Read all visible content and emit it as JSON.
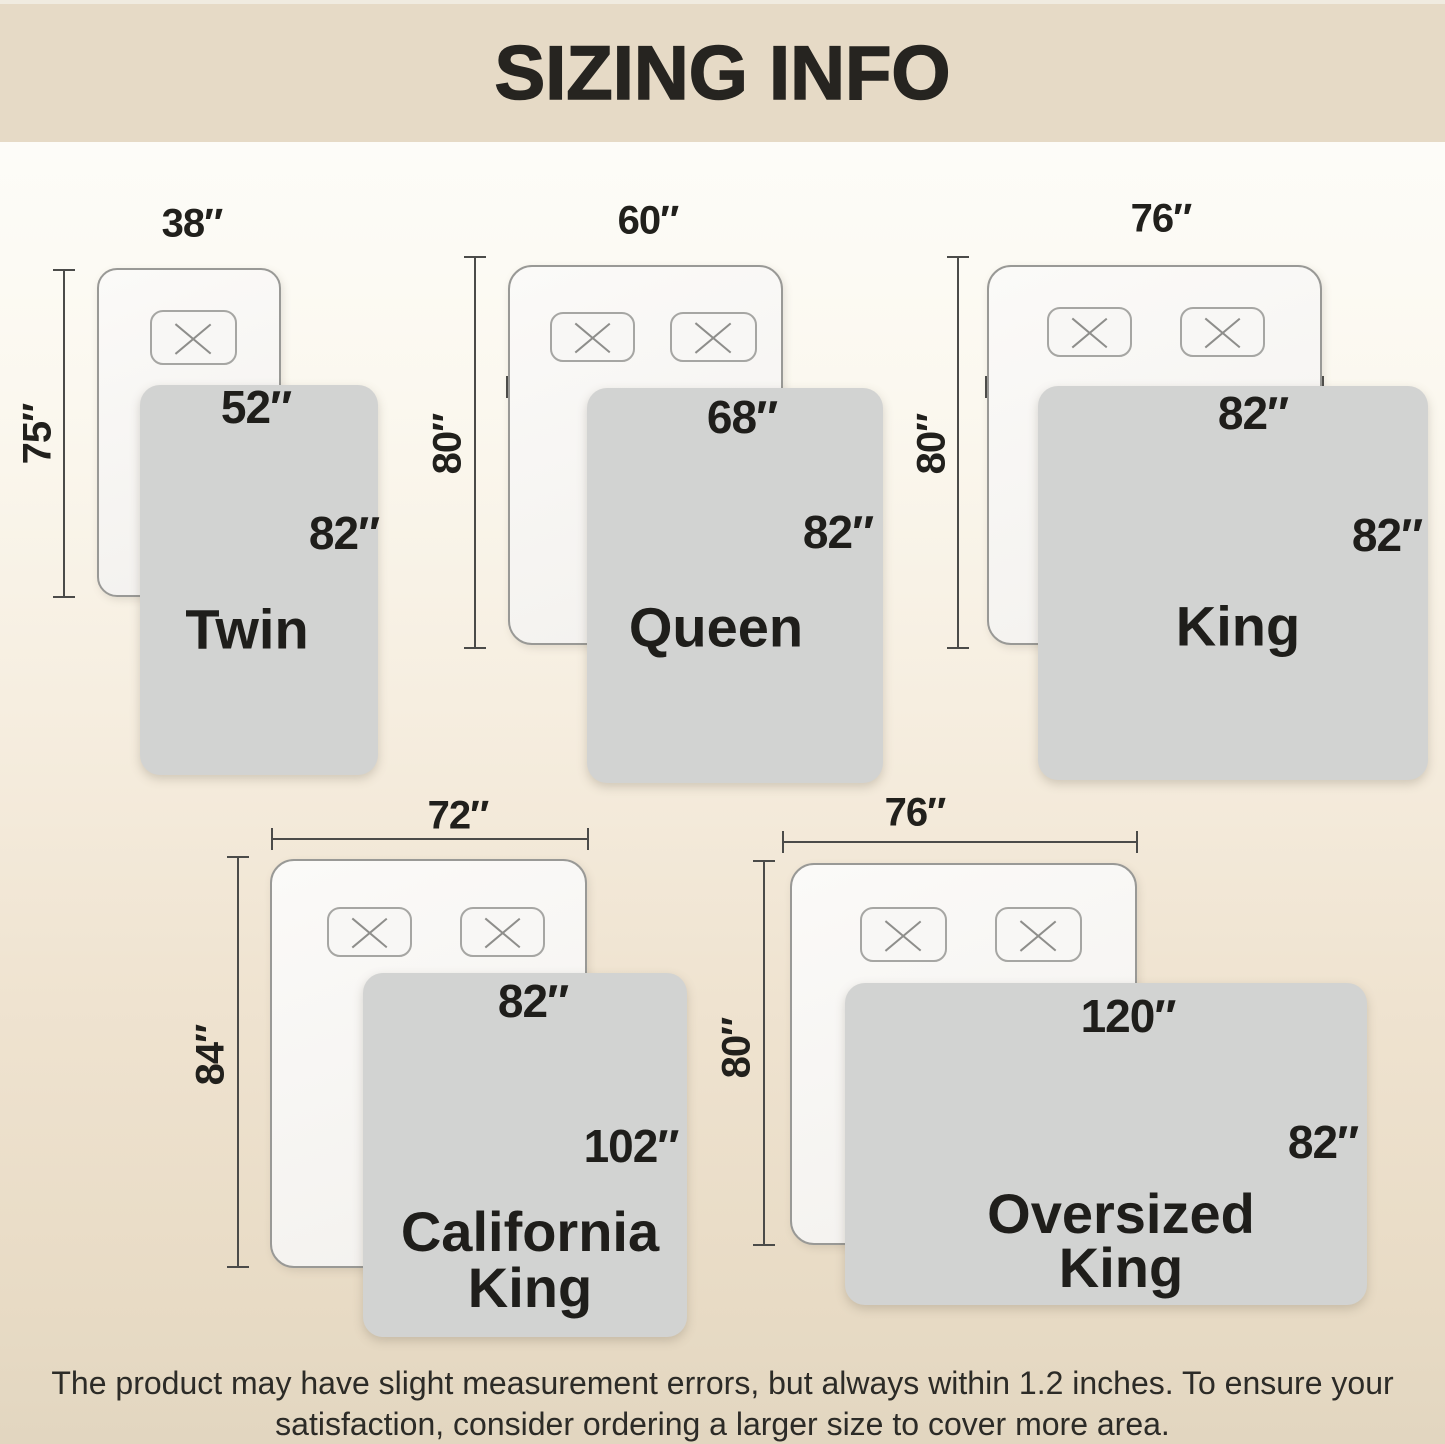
{
  "title": "SIZING INFO",
  "disclaimer": {
    "line1": "The product may have slight measurement errors, but always within 1.2 inches. To ensure your",
    "line2": "satisfaction, consider ordering a larger size to cover more area."
  },
  "sizes": [
    {
      "name": "Twin",
      "bed_width": "38″",
      "bed_length": "75″",
      "blanket_width": "52″",
      "blanket_length": "82″"
    },
    {
      "name": "Queen",
      "bed_width": "60″",
      "bed_length": "80″",
      "blanket_width": "68″",
      "blanket_length": "82″"
    },
    {
      "name": "King",
      "bed_width": "76″",
      "bed_length": "80″",
      "blanket_width": "82″",
      "blanket_length": "82″"
    },
    {
      "name": "California King",
      "name_lines": [
        "California",
        "King"
      ],
      "bed_width": "72″",
      "bed_length": "84″",
      "blanket_width": "82″",
      "blanket_length": "102″"
    },
    {
      "name": "Oversized King",
      "name_lines": [
        "Oversized",
        "King"
      ],
      "bed_width": "76″",
      "bed_length": "80″",
      "blanket_width": "120″",
      "blanket_length": "82″"
    }
  ],
  "colors": {
    "banner": "#e6dac6",
    "background_top": "#fdfcf8",
    "background_bottom": "#e2d6c0",
    "blanket": "#d2d3d2",
    "bed_fill": "#f7f5f2",
    "dimension_line": "#4b4b49",
    "text": "#21201c"
  }
}
